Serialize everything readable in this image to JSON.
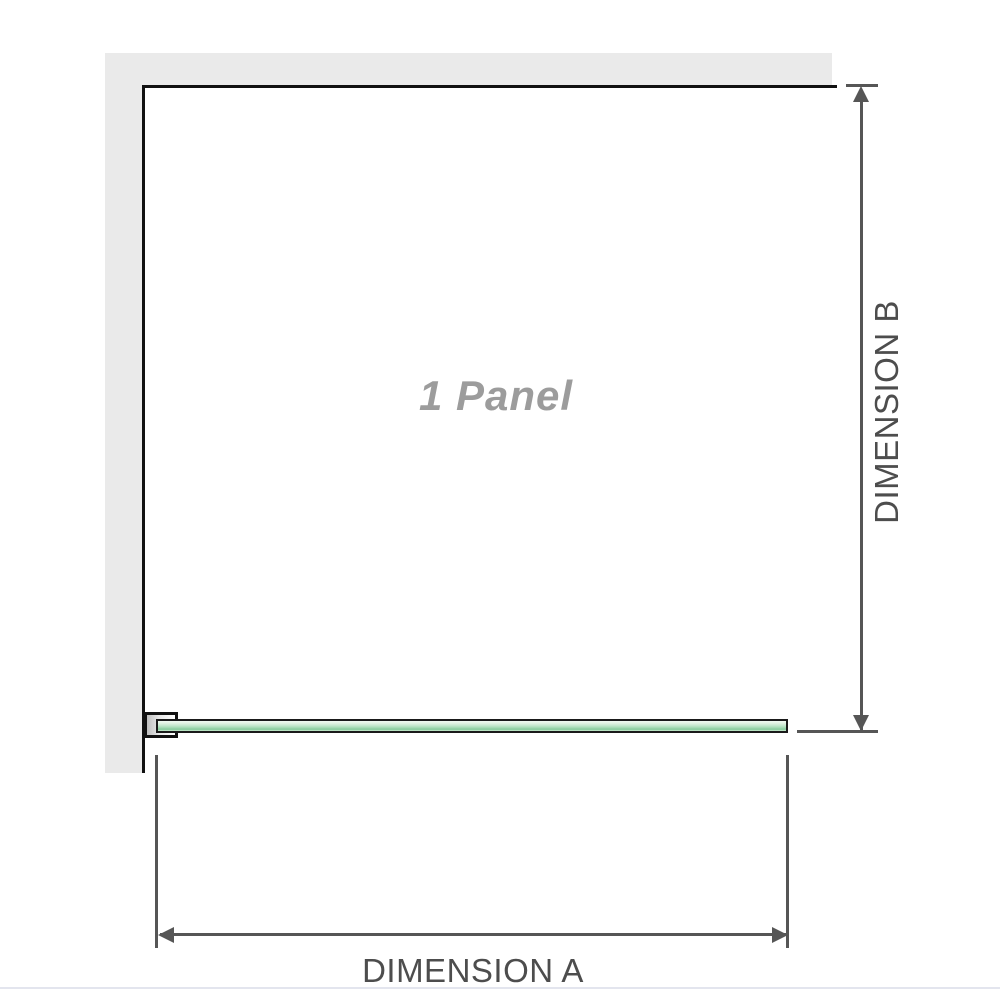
{
  "diagram": {
    "panel_label": "1 Panel",
    "dimension_a_label": "DIMENSION A",
    "dimension_b_label": "DIMENSION B"
  },
  "colors": {
    "wall": "#eaeaea",
    "outline": "#111111",
    "dimension": "#565656",
    "glass_fill": "#b7e4c3",
    "glass_border": "#1a1a1a",
    "label_text": "#4d4d4d",
    "panel_text": "#9c9c9c",
    "bottom_rule": "#e3e5ee"
  }
}
